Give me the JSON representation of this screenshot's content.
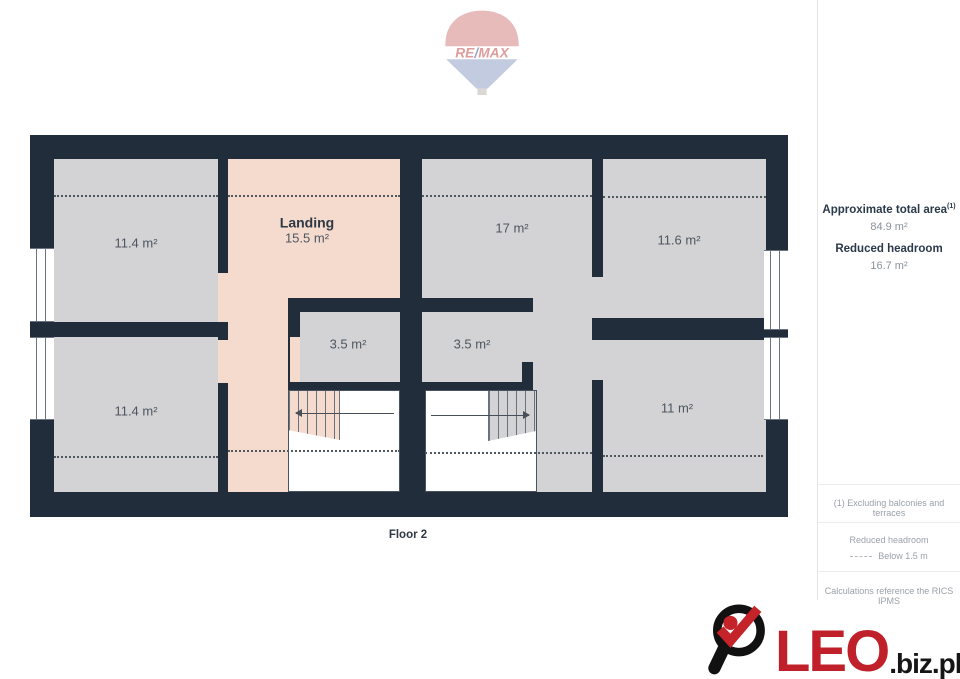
{
  "branding": {
    "remax": {
      "re": "RE",
      "slash": "/",
      "max": "MAX"
    },
    "leo": {
      "name": "LEO",
      "suffix": ".biz.pl"
    }
  },
  "plan": {
    "floor_label": "Floor 2",
    "rooms": {
      "top_left": {
        "area": "11.4 m²"
      },
      "landing": {
        "name": "Landing",
        "area": "15.5 m²"
      },
      "middle_top": {
        "area": "17 m²"
      },
      "top_right": {
        "area": "11.6 m²"
      },
      "closet_left": {
        "area": "3.5 m²"
      },
      "closet_right": {
        "area": "3.5 m²"
      },
      "bottom_left": {
        "area": "11.4 m²"
      },
      "bottom_right": {
        "area": "11 m²"
      }
    }
  },
  "sidebar": {
    "total_area_label": "Approximate total area",
    "total_area_note_ref": "(1)",
    "total_area_value": "84.9 m²",
    "reduced_headroom_label": "Reduced headroom",
    "reduced_headroom_value": "16.7 m²",
    "footnote_1": "(1) Excluding balconies and terraces",
    "legend_title": "Reduced headroom",
    "legend_item": "Below 1.5 m",
    "footnote_2": "Calculations reference the RICS IPMS"
  },
  "icons": {
    "remax_balloon": "hot-air-balloon",
    "leo_logo": "magnifier-checkmark"
  },
  "colors": {
    "wall": "#212d3a",
    "room_fill": "#d3d3d5",
    "landing_fill": "#f5dbce",
    "accent_red": "#c0202a",
    "remax_red": "#c23c3c",
    "remax_blue": "#7f8fbe",
    "dashed_line": "#4f575f"
  }
}
